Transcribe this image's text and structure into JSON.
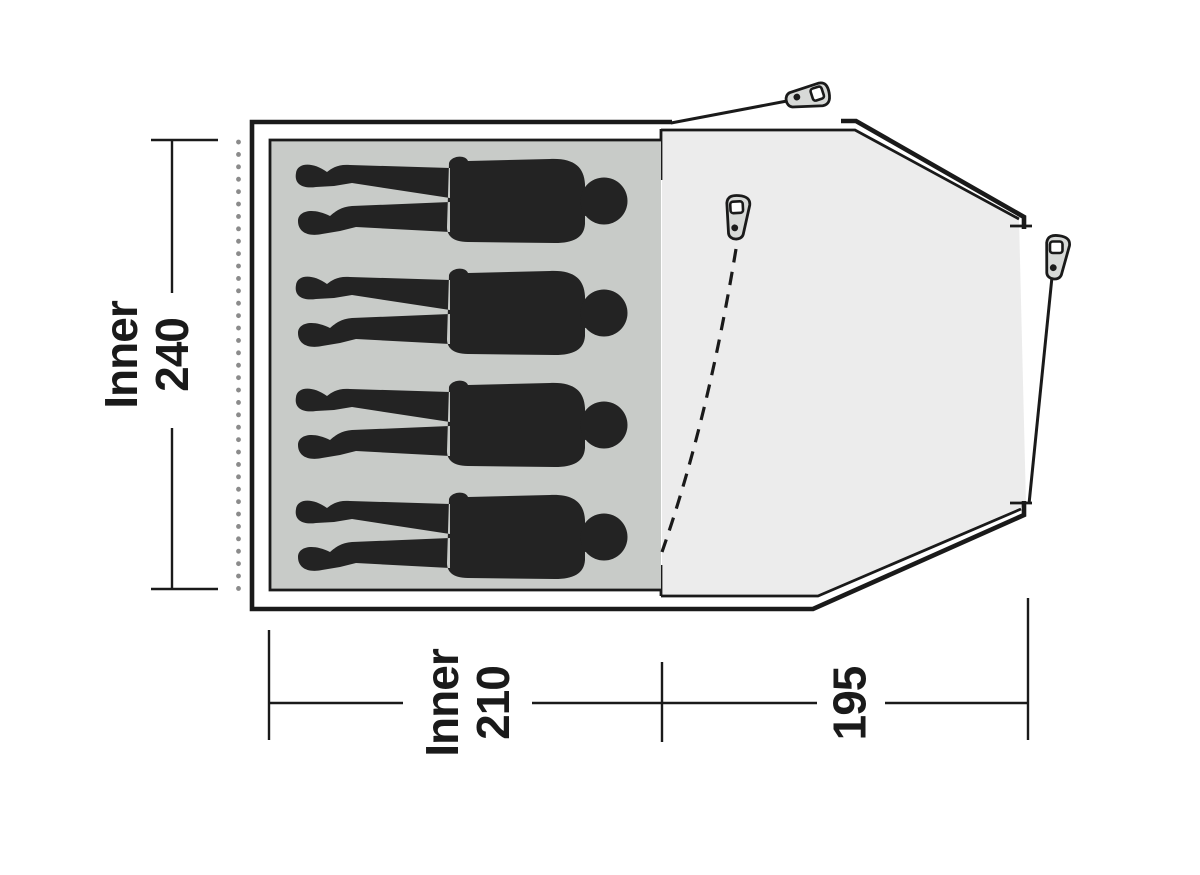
{
  "diagram": {
    "type": "tent-floorplan-top-view",
    "colors": {
      "outline": "#1a1a1a",
      "inner_groundsheet_fill": "#c8cbc8",
      "porch_groundsheet_fill": "#ececec",
      "figure_fill": "#232323",
      "peg_fill": "#d7d9d7",
      "dotted_line": "#8b8b8b"
    },
    "inner_tent": {
      "occupant_count": 4
    },
    "pegs": {
      "count": 3,
      "icon": "tent-peg-icon"
    },
    "dimensions": {
      "inner_depth": {
        "label": "Inner",
        "value": "240"
      },
      "inner_width": {
        "label": "Inner",
        "value": "210"
      },
      "porch_width": {
        "value": "195"
      }
    }
  }
}
